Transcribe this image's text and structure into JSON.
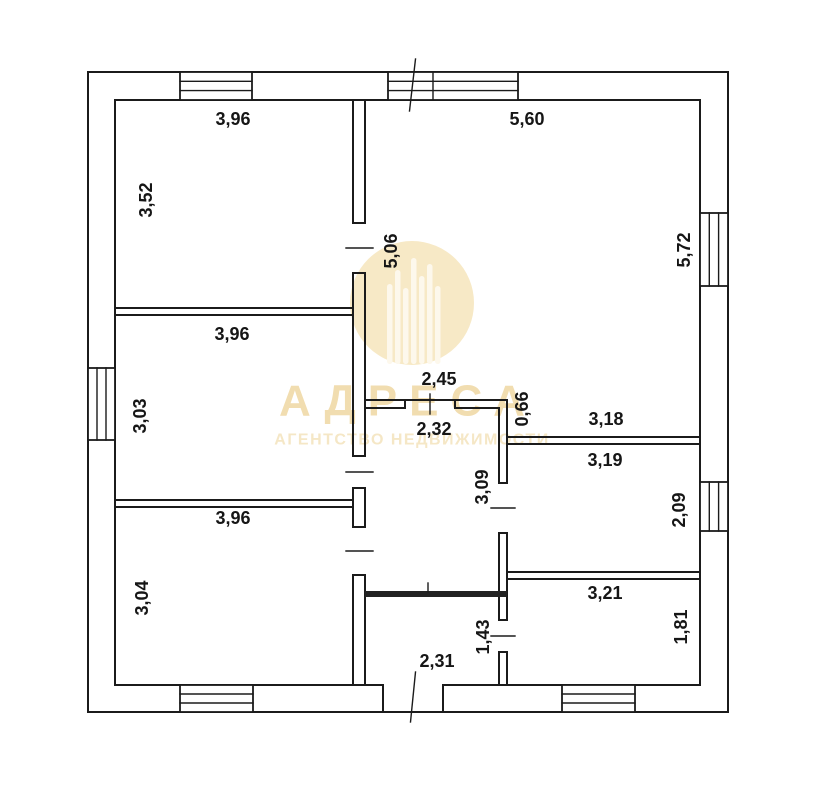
{
  "plan": {
    "dimensions": {
      "room_top_left": {
        "width": "3,96",
        "height": "3,52"
      },
      "room_mid_left": {
        "width": "3,96",
        "height": "3,03"
      },
      "room_bottom_left": {
        "width": "3,96",
        "height": "3,04"
      },
      "room_living": {
        "width": "5,60",
        "height_right": "5,72",
        "height_left": "5,06"
      },
      "passage": {
        "width": "2,45"
      },
      "hall": {
        "width": "2,32",
        "height": "3,09"
      },
      "niche": {
        "height": "0,66",
        "width": "3,18"
      },
      "room_right_mid": {
        "width": "3,19",
        "height": "2,09"
      },
      "room_right_bottom": {
        "width": "3,21",
        "height": "1,81"
      },
      "entry": {
        "width": "2,31",
        "height": "1,43"
      }
    }
  },
  "watermark": {
    "brand": "АДРЕСА",
    "tagline": "АГЕНТСТВО НЕДВИЖИМОСТИ",
    "circle_color": "#f7e9c6",
    "bars_color": "#fdf8ec",
    "text_color": "#f1ddb0",
    "tagline_color": "#f5e7c6"
  },
  "colors": {
    "line": "#1b1b1b",
    "background": "#ffffff"
  }
}
